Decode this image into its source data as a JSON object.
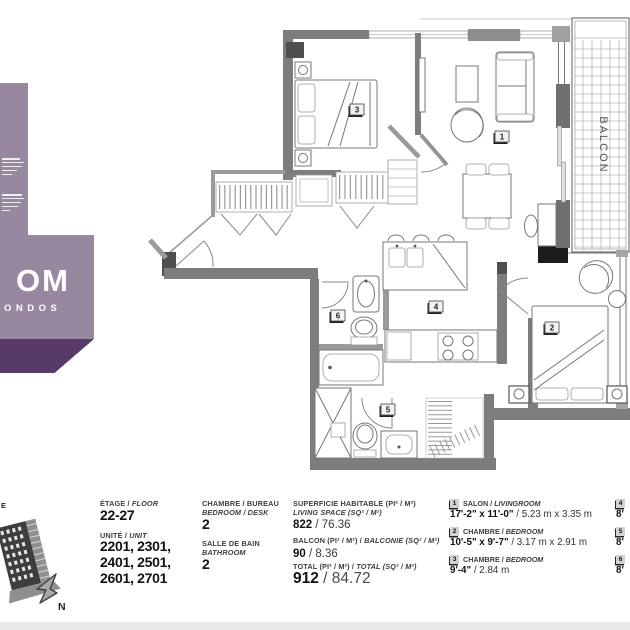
{
  "logo": {
    "name_fragment": "OM",
    "tagline_fragment": "ONDOS",
    "bg_light": "#97879f",
    "bg_dark": "#583a68"
  },
  "plan": {
    "balcony_label": "BALCON",
    "rooms": [
      {
        "num": "1"
      },
      {
        "num": "2"
      },
      {
        "num": "3"
      },
      {
        "num": "4"
      },
      {
        "num": "5"
      },
      {
        "num": "6"
      }
    ]
  },
  "site": {
    "corner_fragment": "E",
    "north_label": "N"
  },
  "legend": {
    "floor": {
      "label_fr": "ÉTAGE /",
      "label_en": "FLOOR",
      "value": "22-27"
    },
    "unit": {
      "label_fr": "UNITÉ /",
      "label_en": "UNIT",
      "lines": [
        "2201, 2301,",
        "2401, 2501,",
        "2601, 2701"
      ]
    },
    "bedroom": {
      "label_fr": "CHAMBRE / BUREAU",
      "label_en": "BEDROOM / DESK",
      "value": "2"
    },
    "bathroom": {
      "label_fr": "SALLE DE BAIN",
      "label_en": "BATHROOM",
      "value": "2"
    },
    "living_space": {
      "label_fr": "SUPERFICIE HABITABLE (PI² / M²)",
      "label_en": "LIVING SPACE (SQ² / M²)",
      "value_main": "822",
      "value_rest": " / 76.36"
    },
    "balcony_area": {
      "label_fr": "BALCON (PI² / M²) /",
      "label_en": "BALCONIE (SQ² / M²)",
      "value_main": "90",
      "value_rest": " / 8.36"
    },
    "total_area": {
      "label_fr": "TOTAL (PI² / M²) /",
      "label_en": "TOTAL (SQ² / M²)",
      "value_main": "912",
      "value_rest": " / 84.72"
    },
    "rooms": [
      {
        "num": "1",
        "label_fr": "SALON /",
        "label_en": "LIVINGROOM",
        "imperial": "17'-2\" x 11'-0\"",
        "metric": " / 5.23 m x 3.35 m"
      },
      {
        "num": "2",
        "label_fr": "CHAMBRE /",
        "label_en": "BEDROOM",
        "imperial": "10'-5\" x 9'-7\"",
        "metric": " / 3.17 m x 2.91 m"
      },
      {
        "num": "3",
        "label_fr": "CHAMBRE /",
        "label_en": "BEDROOM",
        "imperial": "9'-4\"",
        "metric": " / 2.84 m"
      }
    ],
    "rooms_cut": [
      {
        "num": "4",
        "imperial": "8'"
      },
      {
        "num": "5",
        "imperial": "8'"
      },
      {
        "num": "6",
        "imperial": "8'"
      }
    ]
  }
}
